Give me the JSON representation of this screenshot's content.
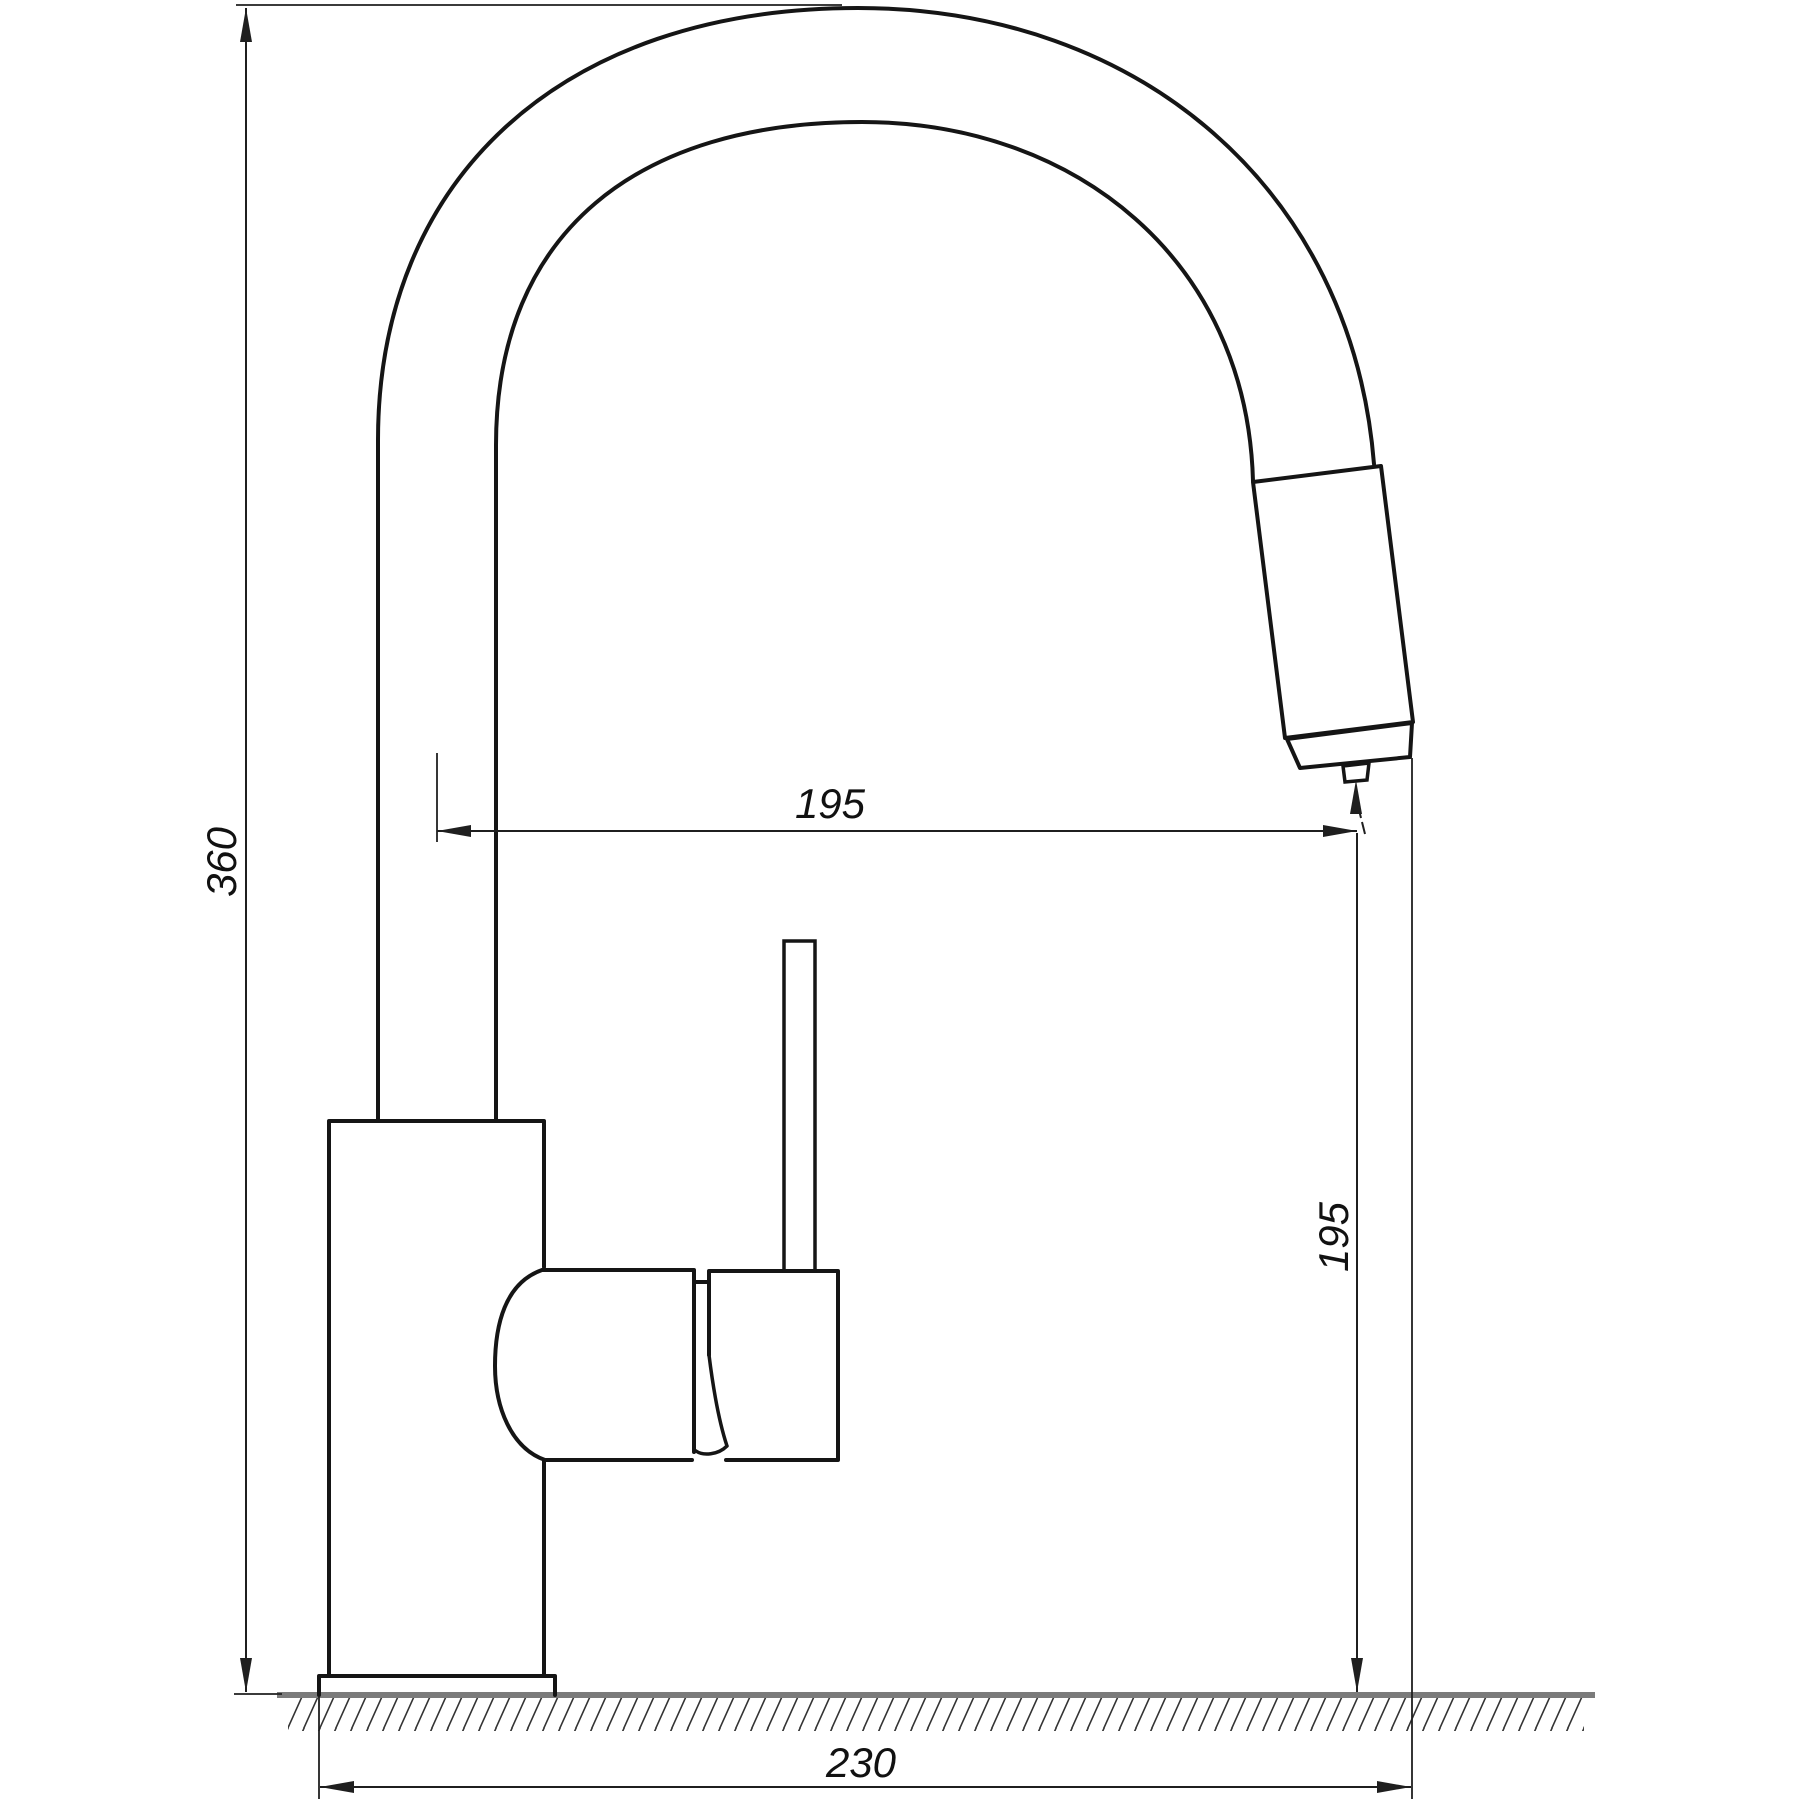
{
  "drawing": {
    "subject": "kitchen-faucet-side-view-technical-drawing",
    "dimensions": {
      "total_height": {
        "value": "360",
        "orientation": "vertical",
        "unit_system": "mm"
      },
      "spout_reach": {
        "value": "195",
        "orientation": "horizontal",
        "unit_system": "mm"
      },
      "outlet_clearance": {
        "value": "195",
        "orientation": "vertical",
        "unit_system": "mm"
      },
      "base_depth": {
        "value": "230",
        "orientation": "horizontal",
        "unit_system": "mm"
      }
    }
  },
  "colors": {
    "bg": "#ffffff",
    "line": "#151515",
    "dim": "#1f1f1f",
    "hatch": "#333333",
    "ground": "#7b7b7b",
    "text": "#111111"
  }
}
